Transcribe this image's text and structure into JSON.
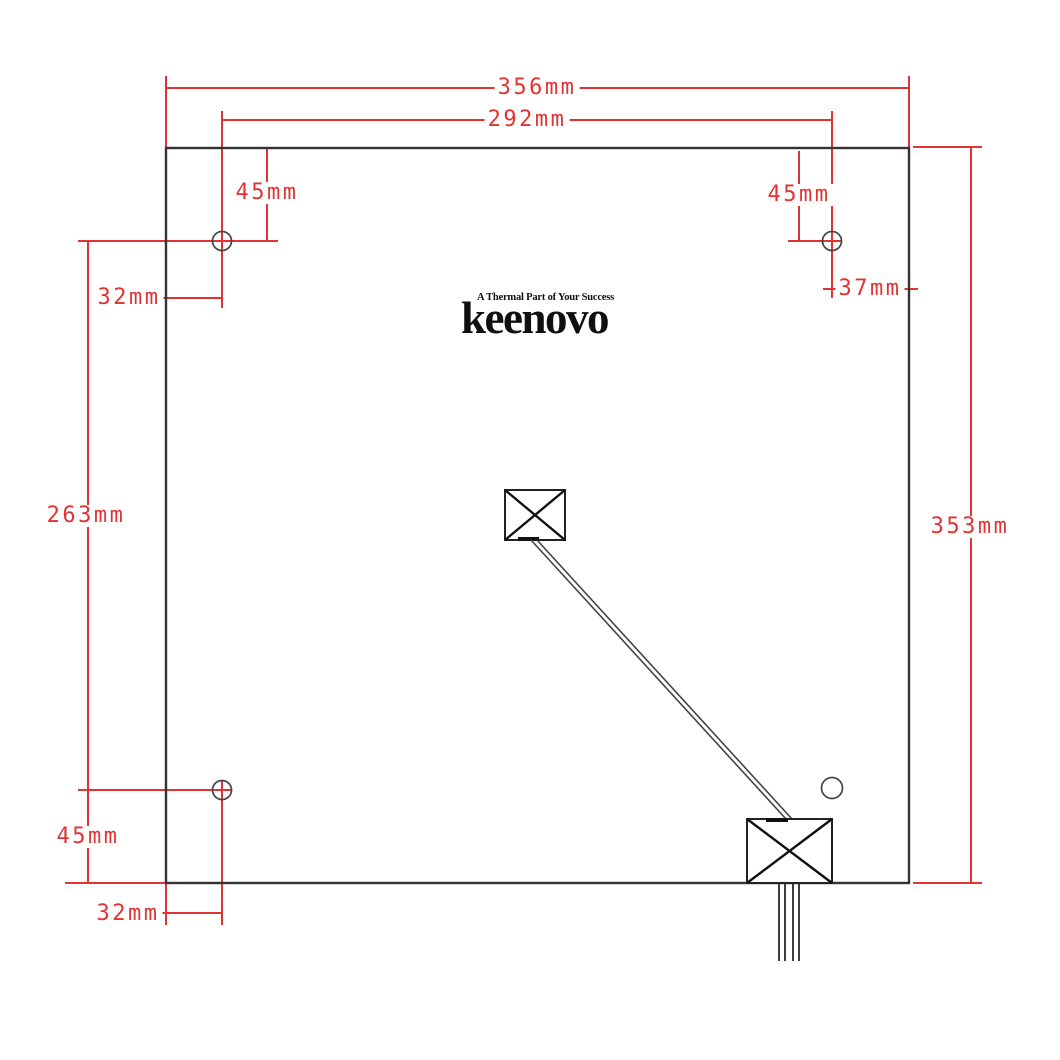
{
  "logo": {
    "tagline": "A Thermal Part of Your Success",
    "brand": "keenovo"
  },
  "dimensions": {
    "overall_width": "356mm",
    "hole_span_width": "292mm",
    "top_left_hole_offset_y": "45mm",
    "top_right_hole_offset_y": "45mm",
    "top_left_hole_offset_x": "32mm",
    "top_right_hole_offset_x": "37mm",
    "hole_span_height": "263mm",
    "overall_height": "353mm",
    "bottom_left_hole_offset_y": "45mm",
    "bottom_left_hole_offset_x": "32mm"
  },
  "colors": {
    "dimension_red": "#e23333",
    "line_black": "#333333"
  }
}
